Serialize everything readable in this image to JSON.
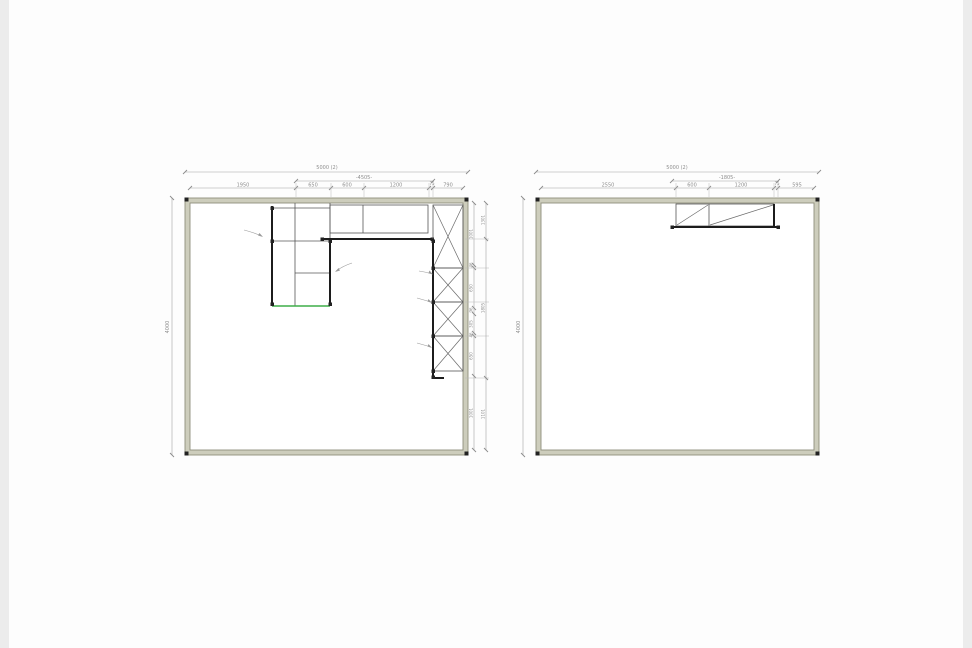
{
  "diagram": {
    "type": "cad-cabinet-elevation-drawing",
    "panels": [
      {
        "id": "left-elevation",
        "dims": {
          "total": "5000 (2)",
          "run": "-4505-",
          "segments": [
            "1950",
            "650",
            "600",
            "1200",
            "75",
            "790"
          ],
          "height": "4000",
          "right_inner": [
            "1001",
            "46",
            "650",
            "96",
            "305",
            "46",
            "650",
            "1001"
          ],
          "right_outer": [
            "1301",
            "1805",
            "1101"
          ]
        }
      },
      {
        "id": "right-elevation",
        "dims": {
          "total": "5000 (2)",
          "run": "-1805-",
          "segments": [
            "2550",
            "600",
            "1200",
            "75",
            "595"
          ],
          "height": "4000"
        }
      }
    ],
    "colors": {
      "wall_fill": "#cdcdbc",
      "wall_edge": "#8f8f7c",
      "thin_line": "#565656",
      "bold_line": "#1c1c1c",
      "dimension": "#a3a3a3",
      "dim_text": "#8f8f8f",
      "accent_green": "#3fae49"
    }
  }
}
